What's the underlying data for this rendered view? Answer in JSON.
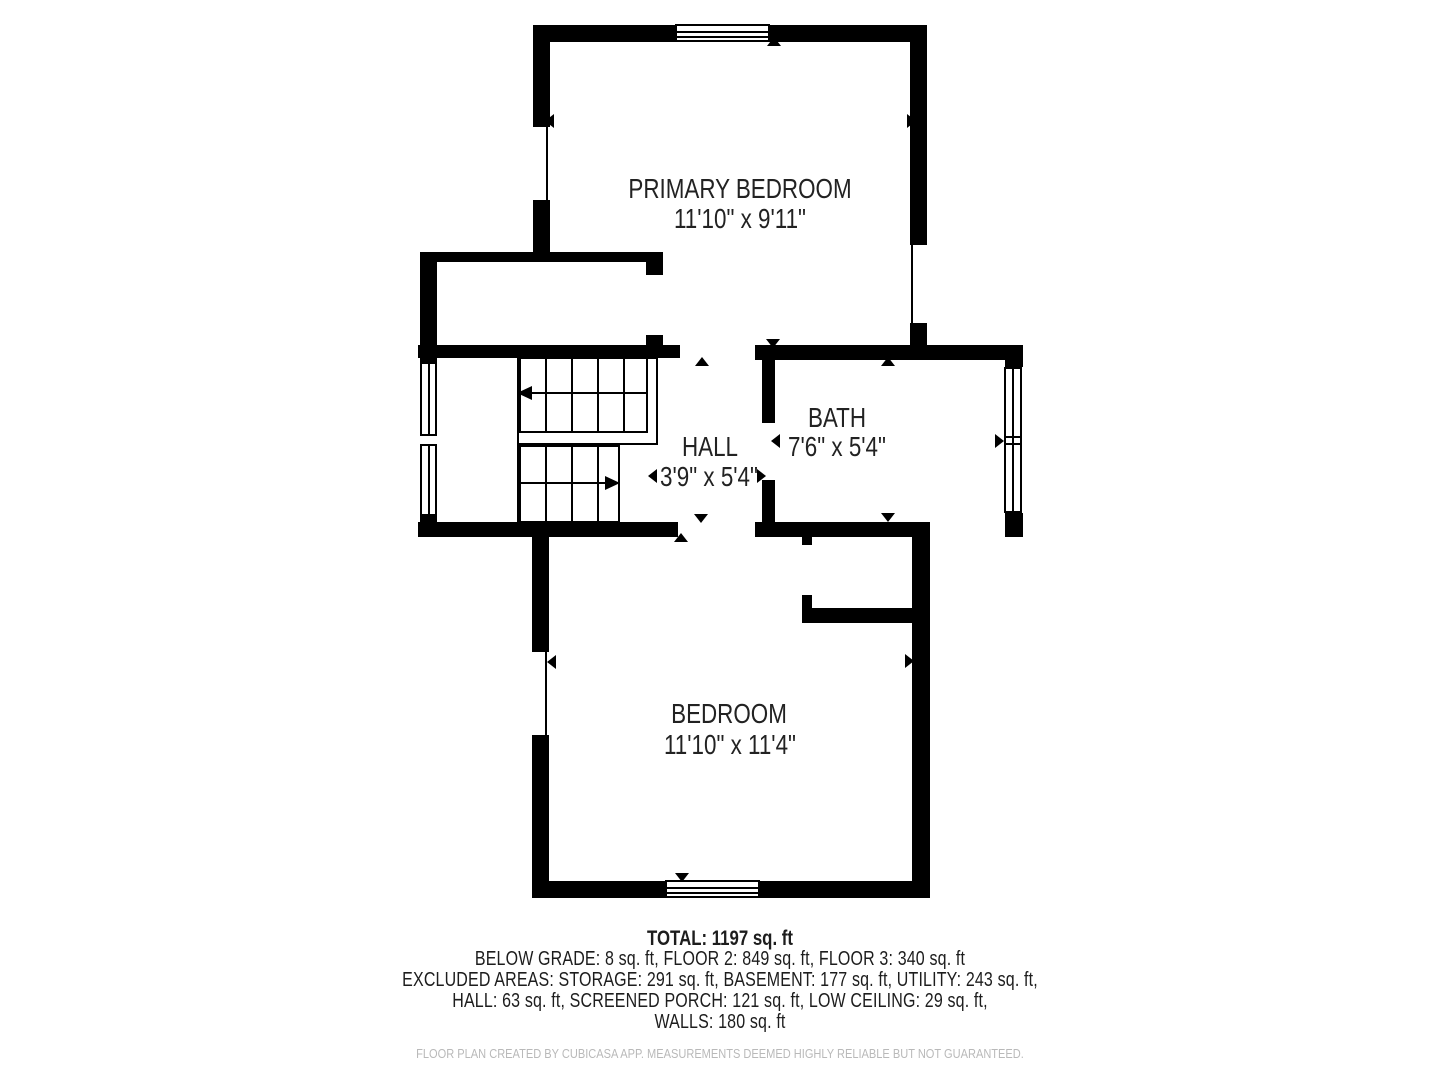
{
  "plan": {
    "rooms": [
      {
        "id": "primary-bedroom",
        "label": "PRIMARY BEDROOM",
        "dimensions": "11'10\" x 9'11\""
      },
      {
        "id": "hall",
        "label": "HALL",
        "dimensions": "3'9\" x 5'4\""
      },
      {
        "id": "bath",
        "label": "BATH",
        "dimensions": "7'6\" x 5'4\""
      },
      {
        "id": "bedroom",
        "label": "BEDROOM",
        "dimensions": "11'10\" x 11'4\""
      }
    ]
  },
  "summary": {
    "total": "TOTAL: 1197 sq. ft",
    "lines": [
      "BELOW GRADE: 8 sq. ft, FLOOR 2: 849 sq. ft, FLOOR 3: 340 sq. ft",
      "EXCLUDED AREAS: STORAGE: 291 sq. ft, BASEMENT: 177 sq. ft, UTILITY: 243 sq. ft,",
      "HALL: 63 sq. ft, SCREENED PORCH: 121 sq. ft, LOW CEILING: 29 sq. ft,",
      "WALLS: 180 sq. ft"
    ]
  },
  "footer": {
    "disclaimer": "FLOOR PLAN CREATED BY CUBICASA APP. MEASUREMENTS DEEMED HIGHLY RELIABLE BUT NOT GUARANTEED."
  },
  "colors": {
    "wall": "#000000",
    "text": "#222222",
    "muted": "#b9b9b9",
    "background": "#ffffff"
  }
}
